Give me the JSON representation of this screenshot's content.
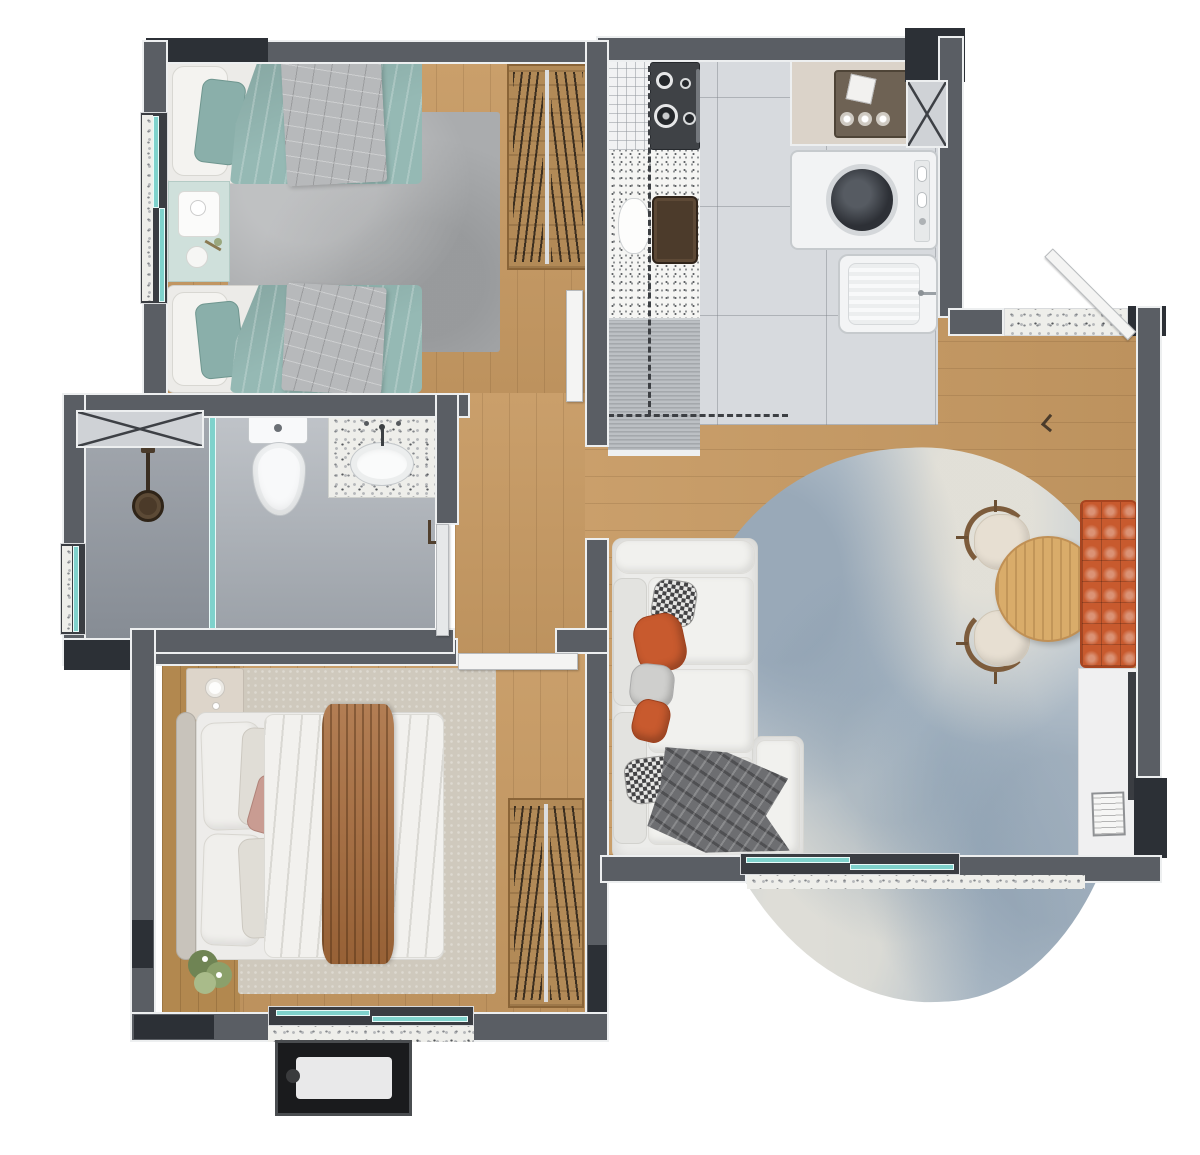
{
  "meta": {
    "title": "Two-bedroom apartment floor plan, top-down 3D render",
    "canvas": {
      "width": 1200,
      "height": 1155
    },
    "visible_text": "none"
  },
  "palette": {
    "wall": "#5a5e64",
    "wallDark": "#2c3036",
    "trim": "#edeff0",
    "wood": "#c79a63",
    "woodDark": "#b2884f",
    "tile": "#d7dade",
    "terrazzo": "#eeeeea",
    "glass": "#7fd2cc",
    "teal": "#95b9b4",
    "grayBlanket": "#b7b9bb",
    "mint": "#cfe0db",
    "rugGray": "#aaacae",
    "rugBeige": "#cfc9bd",
    "rugBlue": "#c3cdd5",
    "sofa": "#ececea",
    "orange": "#c85a2e",
    "throwGray": "#6d6e71",
    "throwBrown": "#a86c3c",
    "tableWood": "#d9ac6a",
    "chairCream": "#e7dfd2",
    "chairWood": "#7d5c3c",
    "wardrobe": "#b28a57",
    "acBlack": "#1a1b1d"
  },
  "labels": {
    "plan": "Apartment floor plan – top view 3D render",
    "bedroom1": "Bedroom 1 with twin beds",
    "bedroom2": "Bedroom 2 with double bed",
    "bathroom": "Bathroom",
    "kitchen": "Kitchen and laundry",
    "living": "Living and dining room",
    "hallway": "Hallway",
    "entry": "Entry landing",
    "twin_bed_top": "Twin bed with teal duvet",
    "twin_bed_bottom": "Twin bed with teal duvet",
    "nightstand1": "Mint nightstand with tray and plant",
    "rug1": "Gray rug",
    "wardrobe1": "Wardrobe with hanging clothes",
    "stove": "Gas cooktop",
    "counter": "Kitchen counter",
    "kitchen_sink": "Counter sink and kettle",
    "steel_counter": "Stainless counter section",
    "cabinet_rack": "Counter with drying rack",
    "niche": "Pantry niche with basket",
    "washer": "Washing machine",
    "laundry_sink": "Laundry tank sink",
    "duct": "Ventilation shaft",
    "shower": "Shower with glass partition",
    "shower_head": "Shower head",
    "toilet": "Toilet",
    "bath_sink": "Bathroom sink on stone counter",
    "double_bed": "Double bed with caramel throw",
    "nightstand2": "Nightstand with lamp",
    "headboard": "Headboard",
    "rug2": "Beige rug",
    "wardrobe2": "Wardrobe with hanging clothes",
    "plant": "Potted plant",
    "sofa": "White sofa with orange cushions",
    "throw_gray": "Gray throw blanket",
    "rug3": "Organic-shaped blue-gray rug",
    "dining_table": "Round wooden dining table",
    "chair_top": "Dining chair",
    "chair_bottom": "Dining chair",
    "bench": "Orange tufted bench",
    "sideboard": "Low white sideboard",
    "magazines": "Magazines on floor",
    "ac_unit": "AC condenser unit",
    "entry_door": "Entry door, open",
    "bedroom1_door": "Bedroom 1 door, open",
    "bedroom2_door": "Bedroom 2 door, open",
    "bathroom_door": "Bathroom door, open",
    "window_bedroom1": "Bedroom 1 window",
    "window_bathroom": "Bathroom window",
    "window_bedroom2": "Bedroom 2 window",
    "window_balcony": "Living room sliding window",
    "window_side": "Side window",
    "balcony_ledge": "Terrazzo ledge"
  }
}
